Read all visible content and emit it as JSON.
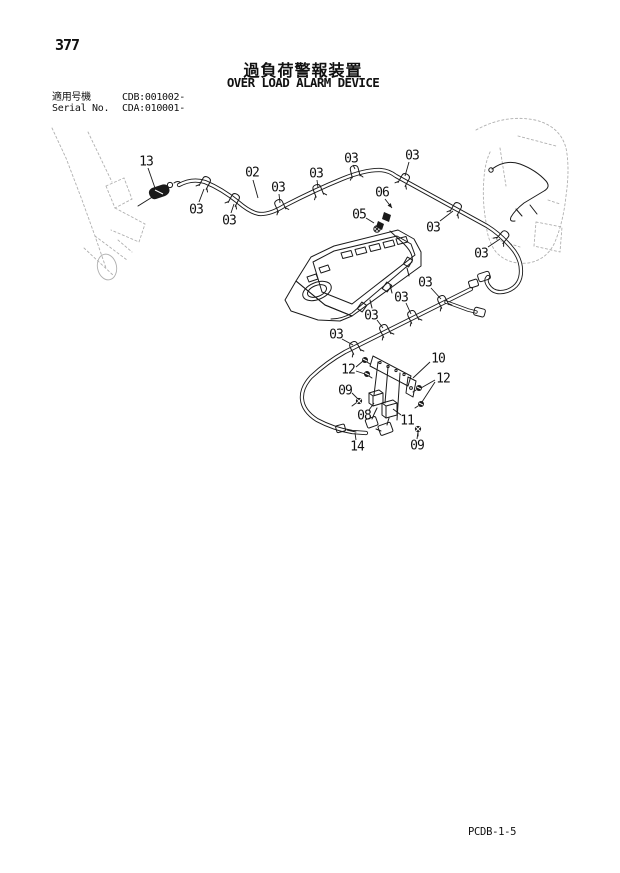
{
  "page": {
    "number": "377",
    "title_ja": "過負荷警報装置",
    "title_en": "OVER LOAD ALARM DEVICE",
    "applicable_label": "適用号機",
    "applicable_value": "CDB:001002-",
    "serial_label": "Serial No.",
    "serial_value": "CDA:010001-",
    "doc_code": "PCDB-1-5"
  },
  "diagram": {
    "callouts": [
      {
        "label": "13",
        "x": 146,
        "y": 161,
        "leaders": [
          [
            148,
            168,
            155,
            188
          ]
        ]
      },
      {
        "label": "03",
        "x": 196,
        "y": 209,
        "leaders": [
          [
            199,
            202,
            204,
            189
          ]
        ]
      },
      {
        "label": "02",
        "x": 252,
        "y": 172,
        "leaders": [
          [
            253,
            180,
            258,
            198
          ]
        ]
      },
      {
        "label": "03",
        "x": 229,
        "y": 220,
        "leaders": [
          [
            231,
            213,
            234,
            204
          ]
        ]
      },
      {
        "label": "03",
        "x": 278,
        "y": 187,
        "leaders": [
          [
            279,
            194,
            280,
            203
          ]
        ]
      },
      {
        "label": "03",
        "x": 316,
        "y": 173,
        "leaders": [
          [
            317,
            180,
            318,
            188
          ]
        ]
      },
      {
        "label": "03",
        "x": 351,
        "y": 158,
        "leaders": [
          [
            353,
            165,
            355,
            169
          ]
        ]
      },
      {
        "label": "03",
        "x": 412,
        "y": 155,
        "leaders": [
          [
            409,
            162,
            405,
            176
          ]
        ]
      },
      {
        "label": "06",
        "x": 382,
        "y": 192,
        "leaders": [
          [
            385,
            199,
            392,
            208
          ]
        ],
        "arrow": true
      },
      {
        "label": "05",
        "x": 359,
        "y": 214,
        "leaders": [
          [
            366,
            218,
            374,
            223
          ]
        ]
      },
      {
        "label": "03",
        "x": 433,
        "y": 227,
        "leaders": [
          [
            440,
            221,
            453,
            211
          ]
        ]
      },
      {
        "label": "03",
        "x": 481,
        "y": 253,
        "leaders": [
          [
            488,
            247,
            500,
            239
          ]
        ]
      },
      {
        "label": "03",
        "x": 425,
        "y": 282,
        "leaders": [
          [
            431,
            288,
            441,
            299
          ]
        ]
      },
      {
        "label": "03",
        "x": 401,
        "y": 297,
        "leaders": [
          [
            406,
            303,
            411,
            314
          ]
        ]
      },
      {
        "label": "03",
        "x": 371,
        "y": 315,
        "leaders": [
          [
            377,
            320,
            383,
            328
          ]
        ]
      },
      {
        "label": "03",
        "x": 336,
        "y": 334,
        "leaders": [
          [
            342,
            339,
            353,
            345
          ]
        ]
      },
      {
        "label": "10",
        "x": 438,
        "y": 358,
        "leaders": [
          [
            430,
            362,
            413,
            378
          ]
        ]
      },
      {
        "label": "12",
        "x": 348,
        "y": 369,
        "leaders": [
          [
            356,
            367,
            363,
            361
          ],
          [
            356,
            371,
            365,
            374
          ]
        ]
      },
      {
        "label": "12",
        "x": 443,
        "y": 378,
        "leaders": [
          [
            435,
            380,
            421,
            388
          ],
          [
            435,
            382,
            422,
            402
          ]
        ]
      },
      {
        "label": "09",
        "x": 345,
        "y": 390,
        "leaders": [
          [
            352,
            393,
            358,
            399
          ]
        ]
      },
      {
        "label": "08",
        "x": 364,
        "y": 415,
        "leaders": [
          [
            369,
            410,
            374,
            403
          ]
        ]
      },
      {
        "label": "11",
        "x": 407,
        "y": 420,
        "leaders": [
          [
            401,
            415,
            393,
            409
          ]
        ]
      },
      {
        "label": "14",
        "x": 357,
        "y": 446,
        "leaders": [
          [
            356,
            440,
            355,
            433
          ]
        ]
      },
      {
        "label": "09",
        "x": 417,
        "y": 445,
        "leaders": [
          [
            417,
            439,
            418,
            432
          ]
        ]
      }
    ]
  }
}
